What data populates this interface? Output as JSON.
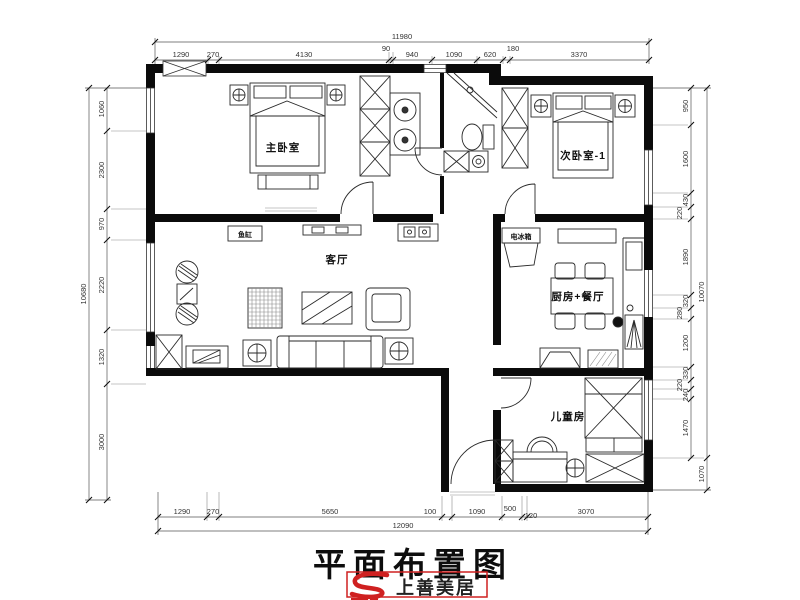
{
  "title": "平面布置图",
  "logo": {
    "brand": "上善美居"
  },
  "rooms": {
    "master": "主卧室",
    "second": "次卧室-1",
    "living": "客厅",
    "kitchen_dining": "厨房+餐厅",
    "kids": "儿童房",
    "fridge": "电冰箱",
    "fish_tank": "鱼缸"
  },
  "dims": {
    "top": {
      "total": "11980",
      "segments": [
        "1290",
        "270",
        "4130",
        "90",
        "940",
        "1090",
        "620",
        "180",
        "3370"
      ]
    },
    "bottom": {
      "total": "12090",
      "segments": [
        "1290",
        "270",
        "5650",
        "100",
        "1090",
        "500",
        "120",
        "3070"
      ]
    },
    "left": {
      "total": "10680",
      "segments": [
        "1060",
        "2300",
        "970",
        "2220",
        "1320",
        "3000"
      ]
    },
    "right": {
      "total": "10070",
      "segments": [
        "950",
        "1600",
        "430",
        "220",
        "1890",
        "320",
        "280",
        "1200",
        "330",
        "220",
        "240",
        "1470",
        "1070"
      ]
    }
  }
}
